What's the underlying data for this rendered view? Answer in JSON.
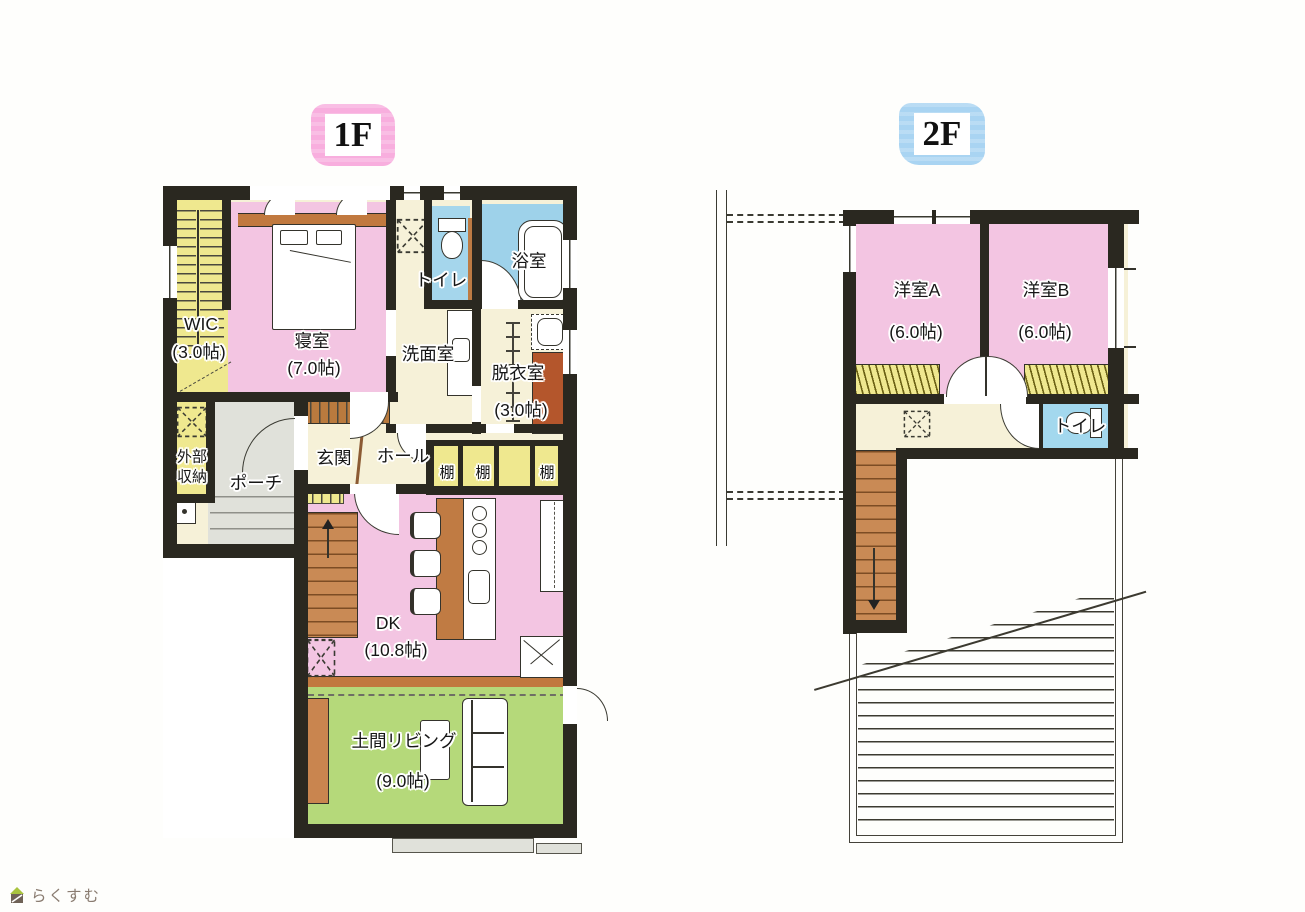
{
  "page": {
    "floor1_label": "1F",
    "floor2_label": "2F"
  },
  "logo": {
    "text": "らくすむ"
  },
  "floor1": {
    "wic_name": "WIC",
    "wic_size": "(3.0帖)",
    "bedroom_name": "寝室",
    "bedroom_size": "(7.0帖)",
    "toilet_name": "トイレ",
    "bath_name": "浴室",
    "washroom_name": "洗面室",
    "dressing_name": "脱衣室",
    "dressing_size": "(3.0帖)",
    "ext_storage_name": "外部収納",
    "porch_name": "ポーチ",
    "entrance_name": "玄関",
    "hall_name": "ホール",
    "shelf1": "棚",
    "shelf2": "棚",
    "shelf3": "棚",
    "dk_name": "DK",
    "dk_size": "(10.8帖)",
    "living_name": "土間リビング",
    "living_size": "(9.0帖)"
  },
  "floor2": {
    "room_a_name": "洋室A",
    "room_a_size": "(6.0帖)",
    "room_b_name": "洋室B",
    "room_b_size": "(6.0帖)",
    "toilet_name": "トイレ"
  },
  "colors": {
    "room_pink": "#f3c5e2",
    "room_blue": "#a5d6ec",
    "room_yellow": "#efe88f",
    "room_green": "#b5d97a",
    "wood_brown": "#c98a55",
    "cabinet_rust": "#b4562c",
    "floor_cream": "#f6f1d8",
    "porch_gray": "#e0e1da",
    "wall_black": "#2a2820",
    "badge_pink": "#f8aede",
    "badge_blue": "#a9d4f2"
  }
}
